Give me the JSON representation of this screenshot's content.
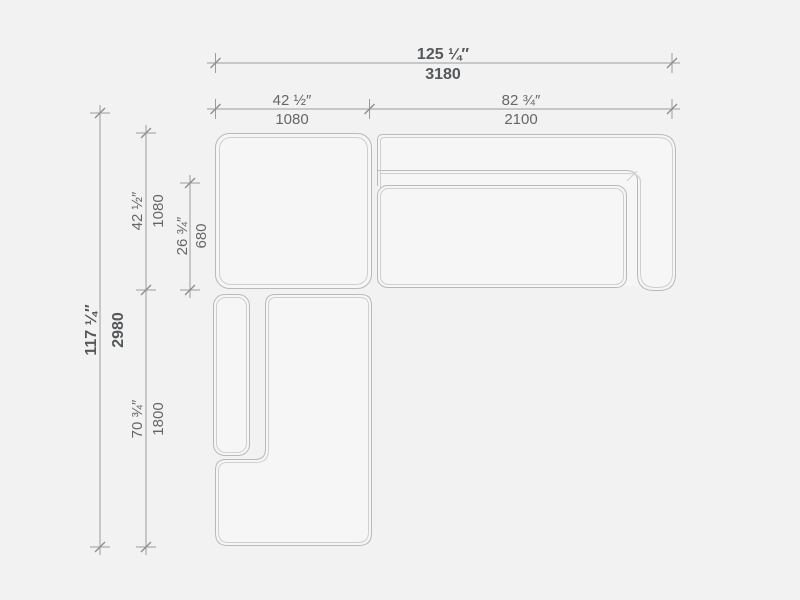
{
  "drawing": {
    "type": "sectional-sofa-top-view-dimension-drawing",
    "dimensions": {
      "overall_width": {
        "inches": "125 ¼″",
        "mm": "3180"
      },
      "left_section_width": {
        "inches": "42 ½″",
        "mm": "1080"
      },
      "right_section_width": {
        "inches": "82 ¾″",
        "mm": "2100"
      },
      "overall_depth": {
        "inches": "117 ¼″",
        "mm": "2980"
      },
      "corner_module_depth": {
        "inches": "42 ½″",
        "mm": "1080"
      },
      "seat_depth": {
        "inches": "26 ¾″",
        "mm": "680"
      },
      "chaise_length": {
        "inches": "70 ¾″",
        "mm": "1800"
      }
    },
    "colors": {
      "background": "#f2f2f2",
      "module_fill": "#f6f6f6",
      "outline": "#b9b9b9",
      "outline_inner": "#cfcfcf",
      "dimension_line": "#9c9c9c",
      "label_text": "#666666",
      "label_text_emphasis": "#55585a"
    }
  }
}
